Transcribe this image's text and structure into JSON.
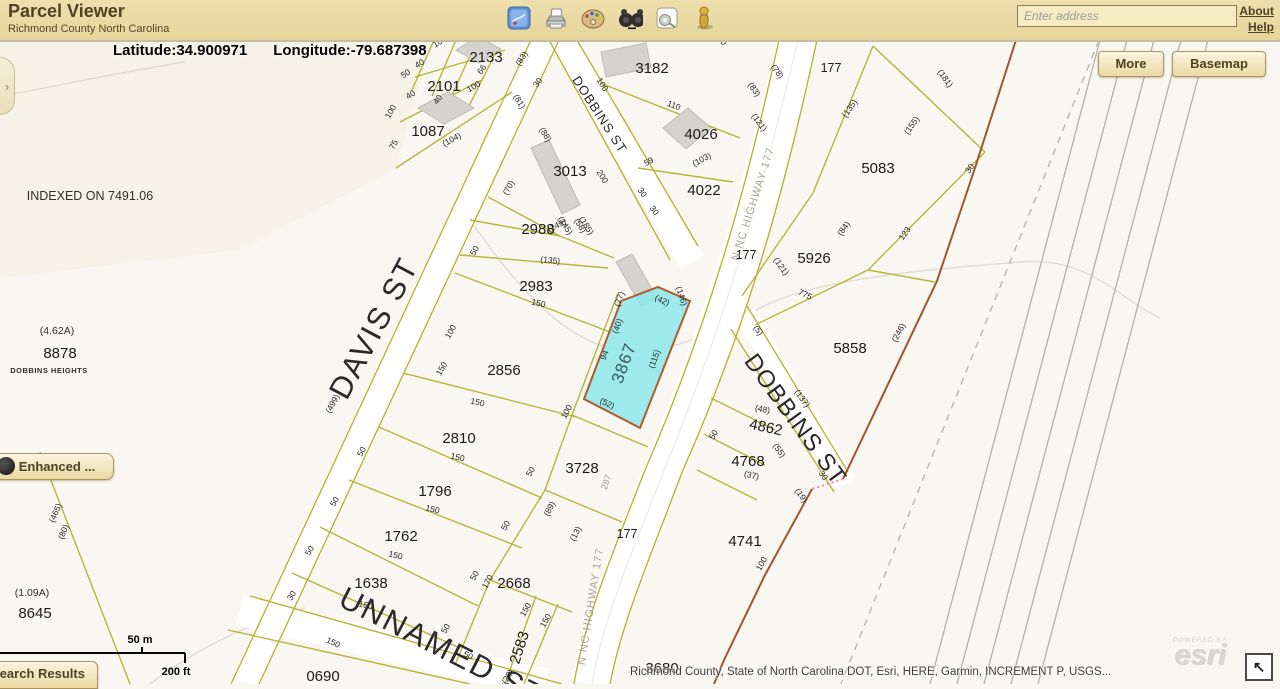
{
  "header": {
    "title": "Parcel Viewer",
    "subtitle": "Richmond County North Carolina",
    "address_placeholder": "Enter address",
    "links": {
      "about": "About",
      "help": "Help"
    }
  },
  "map": {
    "coordinates": {
      "latitude": "Latitude:34.900971",
      "longitude": "Longitude:-79.687398"
    },
    "buttons": {
      "more": "More",
      "basemap": "Basemap",
      "enhanced": "Enhanced ...",
      "search_results": "Search Results"
    },
    "scale": {
      "metric": "50 m",
      "imperial": "200 ft"
    },
    "attribution": "Richmond County, State of North Carolina DOT, Esri, HERE, Garmin, INCREMENT P, USGS...",
    "esri": {
      "powered_by": "POWERED BY",
      "logo": "esri"
    },
    "panel_chevron": "›",
    "fullscreen_arrow": "↖",
    "colors": {
      "highlight_fill": "#8ce8ea",
      "highlight_stroke": "#b05a2c",
      "parcel_line": "#b9b438",
      "boundary": "#a2542c",
      "header_bg": "#e9d9a4"
    },
    "labels": [
      {
        "t": "2133",
        "x": 486,
        "y": 62,
        "r": 0,
        "cls": "p"
      },
      {
        "t": "2101",
        "x": 444,
        "y": 91,
        "r": 0,
        "cls": "p"
      },
      {
        "t": "1087",
        "x": 428,
        "y": 136,
        "r": 0,
        "cls": "p"
      },
      {
        "t": "3182",
        "x": 652,
        "y": 73,
        "r": 0,
        "cls": "p"
      },
      {
        "t": "4026",
        "x": 701,
        "y": 139,
        "r": 0,
        "cls": "p"
      },
      {
        "t": "4022",
        "x": 704,
        "y": 195,
        "r": 0,
        "cls": "p"
      },
      {
        "t": "3013",
        "x": 570,
        "y": 176,
        "r": 0,
        "cls": "p"
      },
      {
        "t": "2988",
        "x": 538,
        "y": 234,
        "r": 0,
        "cls": "p"
      },
      {
        "t": "2983",
        "x": 536,
        "y": 291,
        "r": 0,
        "cls": "p"
      },
      {
        "t": "2856",
        "x": 504,
        "y": 375,
        "r": 0,
        "cls": "p"
      },
      {
        "t": "2810",
        "x": 459,
        "y": 443,
        "r": 0,
        "cls": "p"
      },
      {
        "t": "1796",
        "x": 435,
        "y": 496,
        "r": 0,
        "cls": "p"
      },
      {
        "t": "1762",
        "x": 401,
        "y": 541,
        "r": 0,
        "cls": "p"
      },
      {
        "t": "1638",
        "x": 371,
        "y": 588,
        "r": 0,
        "cls": "p"
      },
      {
        "t": "2668",
        "x": 514,
        "y": 588,
        "r": 0,
        "cls": "p"
      },
      {
        "t": "3728",
        "x": 582,
        "y": 473,
        "r": 0,
        "cls": "p"
      },
      {
        "t": "0690",
        "x": 323,
        "y": 681,
        "r": 0,
        "cls": "p"
      },
      {
        "t": "3680",
        "x": 662,
        "y": 673,
        "r": 0,
        "cls": "p"
      },
      {
        "t": "5083",
        "x": 878,
        "y": 173,
        "r": 0,
        "cls": "p"
      },
      {
        "t": "5926",
        "x": 814,
        "y": 263,
        "r": 0,
        "cls": "p"
      },
      {
        "t": "5858",
        "x": 850,
        "y": 353,
        "r": 0,
        "cls": "p"
      },
      {
        "t": "4862",
        "x": 765,
        "y": 432,
        "r": 12,
        "cls": "p"
      },
      {
        "t": "4768",
        "x": 748,
        "y": 466,
        "r": 0,
        "cls": "p"
      },
      {
        "t": "4741",
        "x": 745,
        "y": 546,
        "r": 0,
        "cls": "p"
      },
      {
        "t": "8878",
        "x": 60,
        "y": 358,
        "r": 0,
        "cls": "p"
      },
      {
        "t": "8645",
        "x": 35,
        "y": 618,
        "r": 0,
        "cls": "p"
      },
      {
        "t": "2583",
        "x": 524,
        "y": 649,
        "r": -72,
        "cls": "p"
      },
      {
        "t": "3867",
        "x": 629,
        "y": 365,
        "r": -70,
        "cls": "hl"
      },
      {
        "t": "177",
        "x": 831,
        "y": 72,
        "r": 0,
        "cls": "p3"
      },
      {
        "t": "177",
        "x": 746,
        "y": 259,
        "r": 0,
        "cls": "p3"
      },
      {
        "t": "177",
        "x": 627,
        "y": 538,
        "r": 0,
        "cls": "p3"
      },
      {
        "t": "DAVIS ST",
        "x": 383,
        "y": 333,
        "r": -62,
        "cls": "s-lg"
      },
      {
        "t": "DOBBINS ST",
        "x": 596,
        "y": 117,
        "r": 57,
        "cls": "s-sm"
      },
      {
        "t": "DOBBINS ST",
        "x": 789,
        "y": 424,
        "r": 54,
        "cls": "s-md"
      },
      {
        "t": "UNNAMED ST",
        "x": 437,
        "y": 656,
        "r": 27,
        "cls": "s-lg"
      },
      {
        "t": "N NC HIGHWAY 177",
        "x": 756,
        "y": 205,
        "r": -72,
        "cls": "hw"
      },
      {
        "t": "N NC HIGHWAY 177",
        "x": 594,
        "y": 607,
        "r": -81,
        "cls": "hw"
      },
      {
        "t": "INDEXED ON 7491.06",
        "x": 90,
        "y": 200,
        "r": 0,
        "cls": "n"
      },
      {
        "t": "(4.62A)",
        "x": 57,
        "y": 334,
        "r": 0,
        "cls": "a"
      },
      {
        "t": "DOBBINS HEIGHTS",
        "x": 49,
        "y": 373,
        "r": 0,
        "cls": "sc"
      },
      {
        "t": "(1.09A)",
        "x": 32,
        "y": 596,
        "r": 0,
        "cls": "a"
      },
      {
        "t": "100",
        "x": 441,
        "y": 44,
        "r": -32,
        "cls": "d"
      },
      {
        "t": "(83)",
        "x": 524,
        "y": 60,
        "r": -58,
        "cls": "d"
      },
      {
        "t": "40",
        "x": 421,
        "y": 66,
        "r": -32,
        "cls": "d"
      },
      {
        "t": "50",
        "x": 407,
        "y": 76,
        "r": -32,
        "cls": "d"
      },
      {
        "t": "66",
        "x": 484,
        "y": 71,
        "r": -55,
        "cls": "d"
      },
      {
        "t": "40",
        "x": 412,
        "y": 97,
        "r": -32,
        "cls": "d"
      },
      {
        "t": "(81)",
        "x": 517,
        "y": 103,
        "r": 58,
        "cls": "d"
      },
      {
        "t": "30",
        "x": 540,
        "y": 84,
        "r": -55,
        "cls": "d"
      },
      {
        "t": "100",
        "x": 600,
        "y": 86,
        "r": 58,
        "cls": "d"
      },
      {
        "t": "100",
        "x": 475,
        "y": 89,
        "r": -30,
        "cls": "d"
      },
      {
        "t": "40",
        "x": 440,
        "y": 101,
        "r": -55,
        "cls": "d"
      },
      {
        "t": "100",
        "x": 393,
        "y": 113,
        "r": -60,
        "cls": "d"
      },
      {
        "t": "75",
        "x": 396,
        "y": 146,
        "r": -60,
        "cls": "d"
      },
      {
        "t": "(104)",
        "x": 453,
        "y": 142,
        "r": -28,
        "cls": "d"
      },
      {
        "t": "(70)",
        "x": 511,
        "y": 189,
        "r": -62,
        "cls": "d"
      },
      {
        "t": "(88)",
        "x": 543,
        "y": 136,
        "r": 58,
        "cls": "d"
      },
      {
        "t": "200",
        "x": 600,
        "y": 178,
        "r": 58,
        "cls": "d"
      },
      {
        "t": "30",
        "x": 640,
        "y": 194,
        "r": 55,
        "cls": "d"
      },
      {
        "t": "30",
        "x": 652,
        "y": 212,
        "r": 55,
        "cls": "d"
      },
      {
        "t": "59",
        "x": 650,
        "y": 164,
        "r": -28,
        "cls": "d"
      },
      {
        "t": "(103)",
        "x": 703,
        "y": 162,
        "r": -28,
        "cls": "d"
      },
      {
        "t": "110",
        "x": 673,
        "y": 108,
        "r": 20,
        "cls": "d"
      },
      {
        "t": "(83)",
        "x": 752,
        "y": 91,
        "r": 55,
        "cls": "d"
      },
      {
        "t": "(121)",
        "x": 757,
        "y": 124,
        "r": 55,
        "cls": "d"
      },
      {
        "t": "(78)",
        "x": 775,
        "y": 73,
        "r": 55,
        "cls": "d"
      },
      {
        "t": "30",
        "x": 720,
        "y": 42,
        "r": 55,
        "cls": "d"
      },
      {
        "t": "(145)",
        "x": 563,
        "y": 227,
        "r": 58,
        "cls": "d"
      },
      {
        "t": "(58)",
        "x": 578,
        "y": 227,
        "r": 58,
        "cls": "d"
      },
      {
        "t": "(149)",
        "x": 558,
        "y": 228,
        "r": -25,
        "cls": "d"
      },
      {
        "t": "(185)",
        "x": 584,
        "y": 227,
        "r": 58,
        "cls": "d"
      },
      {
        "t": "50",
        "x": 477,
        "y": 252,
        "r": -60,
        "cls": "d"
      },
      {
        "t": "(135)",
        "x": 550,
        "y": 263,
        "r": 6,
        "cls": "d"
      },
      {
        "t": "150",
        "x": 538,
        "y": 306,
        "r": 12,
        "cls": "d"
      },
      {
        "t": "100",
        "x": 453,
        "y": 333,
        "r": -60,
        "cls": "d"
      },
      {
        "t": "(77)",
        "x": 622,
        "y": 300,
        "r": -70,
        "cls": "d"
      },
      {
        "t": "(40)",
        "x": 620,
        "y": 327,
        "r": -70,
        "cls": "d"
      },
      {
        "t": "94",
        "x": 607,
        "y": 356,
        "r": -70,
        "cls": "d"
      },
      {
        "t": "(115)",
        "x": 657,
        "y": 360,
        "r": -70,
        "cls": "d"
      },
      {
        "t": "(42)",
        "x": 661,
        "y": 303,
        "r": 25,
        "cls": "d"
      },
      {
        "t": "(146)",
        "x": 679,
        "y": 297,
        "r": 70,
        "cls": "d"
      },
      {
        "t": "(52)",
        "x": 606,
        "y": 406,
        "r": 25,
        "cls": "d"
      },
      {
        "t": "150",
        "x": 444,
        "y": 370,
        "r": -60,
        "cls": "d"
      },
      {
        "t": "(499)",
        "x": 335,
        "y": 405,
        "r": -62,
        "cls": "d"
      },
      {
        "t": "150",
        "x": 477,
        "y": 405,
        "r": 12,
        "cls": "d"
      },
      {
        "t": "100",
        "x": 569,
        "y": 413,
        "r": -62,
        "cls": "d"
      },
      {
        "t": "50",
        "x": 364,
        "y": 453,
        "r": -60,
        "cls": "d"
      },
      {
        "t": "150",
        "x": 457,
        "y": 460,
        "r": 13,
        "cls": "d"
      },
      {
        "t": "(89)",
        "x": 552,
        "y": 510,
        "r": -62,
        "cls": "d"
      },
      {
        "t": "50",
        "x": 337,
        "y": 503,
        "r": -60,
        "cls": "d"
      },
      {
        "t": "150",
        "x": 432,
        "y": 512,
        "r": 13,
        "cls": "d"
      },
      {
        "t": "(13)",
        "x": 578,
        "y": 535,
        "r": -62,
        "cls": "d"
      },
      {
        "t": "50",
        "x": 533,
        "y": 473,
        "r": -60,
        "cls": "d"
      },
      {
        "t": "50",
        "x": 312,
        "y": 552,
        "r": -60,
        "cls": "d"
      },
      {
        "t": "150",
        "x": 395,
        "y": 558,
        "r": 13,
        "cls": "d"
      },
      {
        "t": "50",
        "x": 508,
        "y": 527,
        "r": -60,
        "cls": "d"
      },
      {
        "t": "30",
        "x": 294,
        "y": 597,
        "r": -60,
        "cls": "d"
      },
      {
        "t": "150",
        "x": 365,
        "y": 608,
        "r": 14,
        "cls": "d"
      },
      {
        "t": "50",
        "x": 477,
        "y": 577,
        "r": -60,
        "cls": "d"
      },
      {
        "t": "170",
        "x": 490,
        "y": 583,
        "r": -62,
        "cls": "d"
      },
      {
        "t": "150",
        "x": 332,
        "y": 645,
        "r": 25,
        "cls": "d"
      },
      {
        "t": "150",
        "x": 528,
        "y": 611,
        "r": -60,
        "cls": "d"
      },
      {
        "t": "150",
        "x": 548,
        "y": 622,
        "r": -60,
        "cls": "d"
      },
      {
        "t": "(28)",
        "x": 510,
        "y": 678,
        "r": -60,
        "cls": "d"
      },
      {
        "t": "50",
        "x": 448,
        "y": 630,
        "r": -60,
        "cls": "d"
      },
      {
        "t": "50",
        "x": 467,
        "y": 658,
        "r": 25,
        "cls": "d"
      },
      {
        "t": "(465)",
        "x": 58,
        "y": 514,
        "r": -66,
        "cls": "d"
      },
      {
        "t": "(80)",
        "x": 66,
        "y": 533,
        "r": -66,
        "cls": "d"
      },
      {
        "t": "(48)",
        "x": 762,
        "y": 412,
        "r": 12,
        "cls": "d"
      },
      {
        "t": "50",
        "x": 716,
        "y": 436,
        "r": -62,
        "cls": "d"
      },
      {
        "t": "(55)",
        "x": 777,
        "y": 452,
        "r": 55,
        "cls": "d"
      },
      {
        "t": "(37)",
        "x": 751,
        "y": 478,
        "r": 12,
        "cls": "d"
      },
      {
        "t": "(19)",
        "x": 799,
        "y": 497,
        "r": 55,
        "cls": "d"
      },
      {
        "t": "30",
        "x": 821,
        "y": 477,
        "r": 55,
        "cls": "d"
      },
      {
        "t": "100",
        "x": 764,
        "y": 565,
        "r": -62,
        "cls": "d"
      },
      {
        "t": "(137)",
        "x": 800,
        "y": 400,
        "r": 55,
        "cls": "d"
      },
      {
        "t": "(5)",
        "x": 756,
        "y": 332,
        "r": 55,
        "cls": "d"
      },
      {
        "t": "775",
        "x": 804,
        "y": 297,
        "r": 25,
        "cls": "d"
      },
      {
        "t": "(246)",
        "x": 901,
        "y": 334,
        "r": -62,
        "cls": "d"
      },
      {
        "t": "30",
        "x": 972,
        "y": 170,
        "r": -55,
        "cls": "d"
      },
      {
        "t": "(135)",
        "x": 852,
        "y": 110,
        "r": -55,
        "cls": "d"
      },
      {
        "t": "(155)",
        "x": 914,
        "y": 127,
        "r": -55,
        "cls": "d"
      },
      {
        "t": "(181)",
        "x": 943,
        "y": 80,
        "r": 55,
        "cls": "d"
      },
      {
        "t": "123",
        "x": 907,
        "y": 235,
        "r": -55,
        "cls": "d"
      },
      {
        "t": "(84)",
        "x": 846,
        "y": 230,
        "r": -55,
        "cls": "d"
      },
      {
        "t": "(121)",
        "x": 779,
        "y": 268,
        "r": 55,
        "cls": "d"
      },
      {
        "t": "287",
        "x": 609,
        "y": 483,
        "r": -72,
        "cls": "dg"
      }
    ]
  }
}
